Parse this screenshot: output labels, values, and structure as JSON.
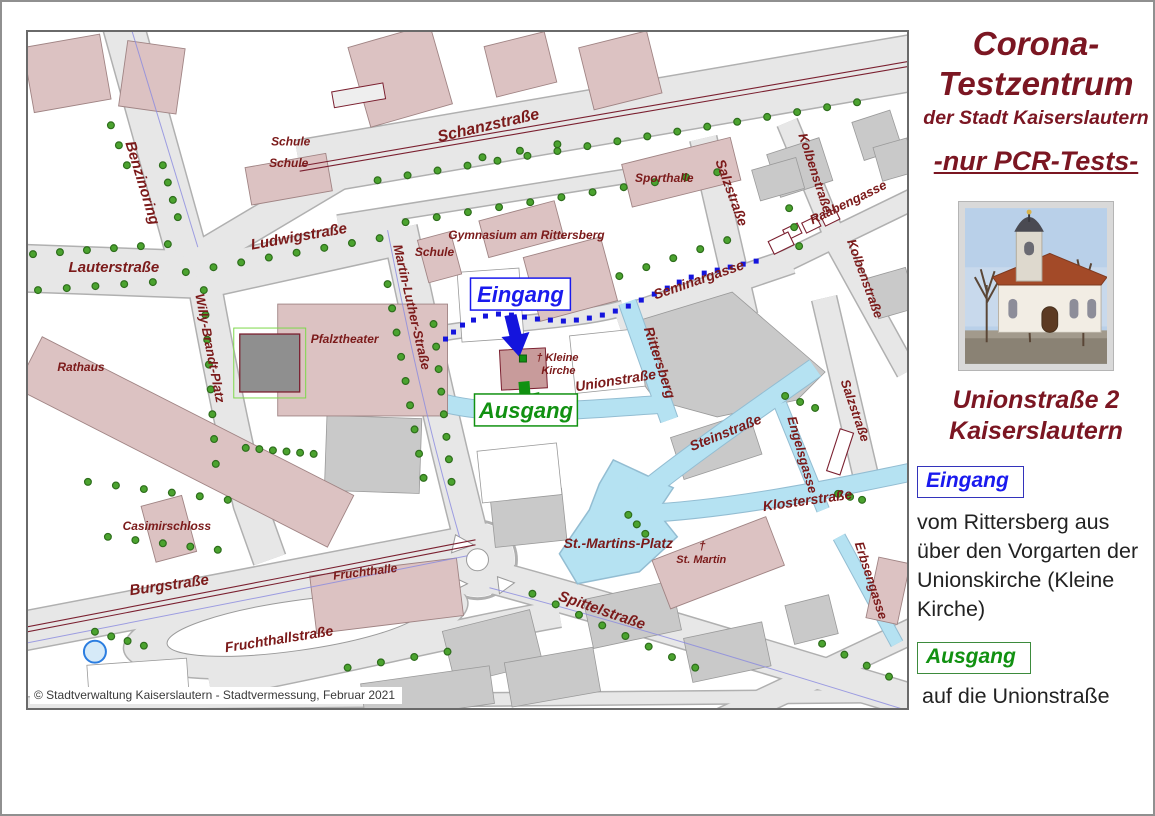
{
  "colors": {
    "pageBg": "#ffffff",
    "outer": "#909090",
    "frame": "#6a6a6a",
    "label": "#7b1a1a",
    "title": "#7b1622",
    "road": "#e7e7e7",
    "roadEdge": "#b0b0b0",
    "block": "#c9c9c9",
    "blockEdge": "#9a9a9a",
    "pink": "#dcc2c2",
    "pinkEdge": "#a08484",
    "pinkDark": "#c89b9b",
    "blue": "#b5e2f2",
    "blueEdge": "#93bdd2",
    "routeBlue": "#1414dd",
    "accentBlue": "#1a1aee",
    "accentGreen": "#119111",
    "tree": "#4ba32f",
    "treeEdge": "#2e6e1c",
    "tram": "#7b2030",
    "curb": "#8a8ae0",
    "text": "#1f1f1f",
    "copyright": "#3a3a3a"
  },
  "sidebar": {
    "title_line1": "Corona-",
    "title_line2": "Testzentrum",
    "subtitle": "der Stadt Kaiserslautern",
    "pcr_note": "-nur PCR-Tests-",
    "photo_icon": "church-photo",
    "address_line1": "Unionstraße 2",
    "address_line2": "Kaiserslautern",
    "entrance_label": "Eingang",
    "entrance_text": "vom Rittersberg aus über den Vorgarten der Unionskirche (Kleine Kirche)",
    "exit_label": "Ausgang",
    "exit_text": "auf die Unionstraße"
  },
  "map": {
    "copyright": "© Stadtverwaltung Kaiserslautern - Stadtvermessung, Februar 2021",
    "boxes": [
      {
        "t": "Eingang",
        "x": 443,
        "y": 246,
        "w": 100,
        "h": 32,
        "c": "blue",
        "fs": 22
      },
      {
        "t": "Ausgang",
        "x": 447,
        "y": 362,
        "w": 103,
        "h": 32,
        "c": "green",
        "fs": 22
      }
    ],
    "labels": [
      {
        "t": "Benzinoring",
        "x": 110,
        "y": 152,
        "r": 73,
        "s": 15
      },
      {
        "t": "Schanzstraße",
        "x": 462,
        "y": 98,
        "r": -13,
        "s": 16
      },
      {
        "t": "Schule",
        "x": 263,
        "y": 113,
        "r": 0,
        "s": 12
      },
      {
        "t": "Schule",
        "x": 261,
        "y": 135,
        "r": 0,
        "s": 12
      },
      {
        "t": "Sporthalle",
        "x": 637,
        "y": 150,
        "r": 0,
        "s": 12
      },
      {
        "t": "Ludwigstraße",
        "x": 272,
        "y": 209,
        "r": -10,
        "s": 15
      },
      {
        "t": "Lauterstraße",
        "x": 86,
        "y": 240,
        "r": 0,
        "s": 15
      },
      {
        "t": "Salzstraße",
        "x": 700,
        "y": 162,
        "r": 70,
        "s": 14
      },
      {
        "t": "Kolbenstraße",
        "x": 784,
        "y": 142,
        "r": 72,
        "s": 13
      },
      {
        "t": "Raabengasse",
        "x": 823,
        "y": 174,
        "r": -26,
        "s": 13
      },
      {
        "t": "Kolbenstraße",
        "x": 834,
        "y": 248,
        "r": 70,
        "s": 13
      },
      {
        "t": "Seminargasse",
        "x": 673,
        "y": 252,
        "r": -19,
        "s": 14
      },
      {
        "t": "Gymnasium am Rittersberg",
        "x": 499,
        "y": 207,
        "r": 0,
        "s": 12
      },
      {
        "t": "Schule",
        "x": 407,
        "y": 224,
        "r": 0,
        "s": 12
      },
      {
        "t": "Martin-Luther-Straße",
        "x": 380,
        "y": 276,
        "r": 77,
        "s": 13
      },
      {
        "t": "Willy-Brandt-Platz",
        "x": 178,
        "y": 317,
        "r": 79,
        "s": 13
      },
      {
        "t": "Pfalztheater",
        "x": 317,
        "y": 311,
        "r": 0,
        "s": 12
      },
      {
        "t": "Rathaus",
        "x": 53,
        "y": 339,
        "r": 0,
        "s": 12
      },
      {
        "t": "Rittersberg",
        "x": 628,
        "y": 332,
        "r": 72,
        "s": 14
      },
      {
        "t": "Unionstraße",
        "x": 589,
        "y": 353,
        "r": -9,
        "s": 14
      },
      {
        "t": "† Kleine",
        "x": 530,
        "y": 329,
        "r": 0,
        "s": 11
      },
      {
        "t": "Kirche",
        "x": 531,
        "y": 342,
        "r": 0,
        "s": 11
      },
      {
        "t": "Steinstraße",
        "x": 700,
        "y": 405,
        "r": -22,
        "s": 14
      },
      {
        "t": "Engelsgasse",
        "x": 771,
        "y": 424,
        "r": 74,
        "s": 13
      },
      {
        "t": "Salzstraße",
        "x": 824,
        "y": 380,
        "r": 71,
        "s": 13
      },
      {
        "t": "Klosterstraße",
        "x": 781,
        "y": 473,
        "r": -8,
        "s": 14
      },
      {
        "t": "Erbsengasse",
        "x": 840,
        "y": 550,
        "r": 72,
        "s": 13
      },
      {
        "t": "St.-Martins-Platz",
        "x": 591,
        "y": 516,
        "r": 0,
        "s": 14
      },
      {
        "t": "†",
        "x": 675,
        "y": 518,
        "r": 0,
        "s": 12
      },
      {
        "t": "St. Martin",
        "x": 674,
        "y": 531,
        "r": 0,
        "s": 11
      },
      {
        "t": "Casimirschloss",
        "x": 139,
        "y": 498,
        "r": 0,
        "s": 12
      },
      {
        "t": "Burgstraße",
        "x": 142,
        "y": 558,
        "r": -8,
        "s": 15
      },
      {
        "t": "Fruchthalle",
        "x": 338,
        "y": 544,
        "r": -7,
        "s": 12
      },
      {
        "t": "Fruchthallstraße",
        "x": 252,
        "y": 612,
        "r": -9,
        "s": 14
      },
      {
        "t": "Spittelstraße",
        "x": 573,
        "y": 583,
        "r": 19,
        "s": 15
      }
    ],
    "tree_rows": [
      [
        350,
        148,
        830,
        70,
        17
      ],
      [
        378,
        190,
        690,
        140,
        11
      ],
      [
        5,
        222,
        140,
        212,
        6
      ],
      [
        10,
        258,
        125,
        250,
        5
      ],
      [
        158,
        240,
        352,
        206,
        8
      ],
      [
        176,
        258,
        188,
        432,
        8
      ],
      [
        360,
        252,
        396,
        446,
        9
      ],
      [
        406,
        292,
        424,
        450,
        8
      ],
      [
        218,
        416,
        286,
        422,
        6
      ],
      [
        60,
        450,
        200,
        468,
        6
      ],
      [
        80,
        505,
        190,
        518,
        5
      ],
      [
        67,
        600,
        116,
        614,
        4
      ],
      [
        505,
        562,
        668,
        636,
        8
      ],
      [
        320,
        636,
        420,
        620,
        4
      ],
      [
        592,
        244,
        700,
        208,
        5
      ],
      [
        601,
        483,
        618,
        502,
        3
      ],
      [
        811,
        462,
        835,
        468,
        3
      ],
      [
        758,
        364,
        788,
        376,
        3
      ],
      [
        795,
        612,
        862,
        645,
        4
      ],
      [
        83,
        93,
        99,
        133,
        3
      ],
      [
        135,
        133,
        150,
        185,
        4
      ],
      [
        455,
        125,
        530,
        112,
        3
      ],
      [
        762,
        176,
        772,
        214,
        3
      ]
    ],
    "route_dots": [
      [
        418,
        307
      ],
      [
        426,
        300
      ],
      [
        435,
        293
      ],
      [
        446,
        288
      ],
      [
        458,
        284
      ],
      [
        471,
        282
      ],
      [
        484,
        283
      ],
      [
        497,
        285
      ],
      [
        510,
        287
      ],
      [
        523,
        288
      ],
      [
        536,
        289
      ],
      [
        549,
        288
      ],
      [
        562,
        286
      ],
      [
        575,
        283
      ],
      [
        588,
        279
      ],
      [
        601,
        274
      ],
      [
        614,
        268
      ],
      [
        627,
        262
      ],
      [
        640,
        256
      ],
      [
        652,
        250
      ],
      [
        664,
        245
      ],
      [
        677,
        241
      ],
      [
        690,
        238
      ],
      [
        703,
        235
      ],
      [
        716,
        232
      ],
      [
        729,
        229
      ]
    ]
  }
}
